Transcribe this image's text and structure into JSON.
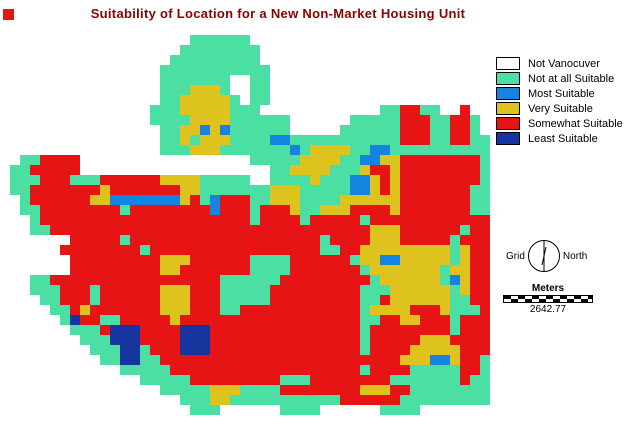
{
  "title": "Suitability of Location for a New Non-Market Housing Unit",
  "title_color": "#8B0000",
  "marker_color": "#E61414",
  "legend": {
    "items": [
      {
        "label": "Not Vanocuver",
        "color": "#FFFFFF"
      },
      {
        "label": "Not at all Suitable",
        "color": "#4CDFA3"
      },
      {
        "label": "Most Suitable",
        "color": "#1583E0"
      },
      {
        "label": "Very Suitable",
        "color": "#DEC31E"
      },
      {
        "label": "Somewhat Suitable",
        "color": "#E61414"
      },
      {
        "label": "Least Suitable",
        "color": "#16359E"
      }
    ]
  },
  "compass": {
    "left_label": "Grid",
    "right_label": "North"
  },
  "scalebar": {
    "unit_label": "Meters",
    "value": "2642.77"
  },
  "map": {
    "cell": 10,
    "colors": {
      "W": "#FFFFFF",
      "T": "#4CDFA3",
      "B": "#1583E0",
      "Y": "#DEC31E",
      "R": "#E61414",
      "N": "#16359E"
    },
    "rows_rle": [
      "19W 6T 24W",
      "18W 8T 23W",
      "17W 9T 23W",
      "16W 11T 22W",
      "16W 7T 2W 2T 22W",
      "16W 3T 3Y 1T 2W 2T 22W",
      "16W 2T 5Y 1T 1W 2T 22W",
      "15W 3T 5Y 3T 12W 2T 2R 2T 2W 1R 2W",
      "15W 4T 4Y 6T 6W 5T 3R 2T 2R 1T 1W",
      "16W 2T 2Y 1B 1Y 1B 6T 5W 6T 3R 2T 2R 1T 1W",
      "16W 2T 1Y 1T 3Y 4T 2B 11T 3R 2T 2R 2T",
      "16W 3T 3Y 7T 1B 1T 4Y 2T 2B 11T",
      "2W 2T 4R 17W 5T 4Y 2T 2B 2Y 8R 1T",
      "1W 2T 5R 19W 2T 4Y 3T 1Y 2R 1Y 8R 1T",
      "1W 3T 3R 3T 6R 4Y 5T 2W 4T 1Y 3T 2B 1Y 1R 1Y 8R 1T",
      "1W 2T 7R 1Y 7R 2Y 7T 3Y 5T 2B 1Y 1R 1Y 7R 2T",
      "2W 1T 6R 2Y 7B 1Y 1R 1T 1B 3R 2T 3Y 4T 6Y 7R 2T",
      "2W 2T 8R 1T 8R 1B 3R 1T 3R 1Y 2T 3Y 4R 1Y 7R 2T",
      "3W 1T 21R 1T 4R 1T 5R 1T 12R",
      "3W 2T 32R 3Y 6R 1T 2R",
      "7W 5R 1T 19R 1T 4R 3Y 5R 1T 3R",
      "6W 8R 1T 17R 2T 2R 9Y 1T 1Y 2R",
      "7W 9R 3Y 6R 4T 6R 1T 2Y 2B 5Y 1T 1Y 2R",
      "7W 9R 2Y 7R 4T 7R 1T 7Y 1T 2Y 2R",
      "3W 2T 17R 6T 9R 1T 6Y 1T 1B 1Y 2R",
      "3W 3T 3R 1T 6R 3Y 3R 5T 9R 3T 6Y 1T 1Y 2R",
      "4W 2T 3R 1T 6R 3Y 3R 5T 9R 2T 1R 6Y 2T 2R",
      "5W 2T 1R 1Y 7R 3Y 3R 2T 12R 1T 4Y 3R 1Y 3T 1R",
      "6W 1T 1N 2R 2T 5R 1Y 18R 2T 2R 2Y 3R 1T 3R",
      "7W 3T 1R 3N 4R 3N 15R 1T 8R 1T 3R",
      "8W 3T 3N 4R 3N 15R 1T 5R 3Y 4R",
      "9W 3T 2N 1T 3R 3N 15R 1T 4R 5Y 3R",
      "10W 2T 2N 2T 24R 3Y 2B 1Y 2R 1T",
      "12W 5T 19R 1T 4R 5T 2R 1T",
      "14W 5T 9R 3T 8R 7T 1R 2T",
      "16W 5T 3Y 4T 8R 3Y 2R 8T",
      "18W 3T 2Y 11T 6R 9T",
      "19W 3T 6W 4T 6W 4T 7W",
      "49W"
    ]
  }
}
